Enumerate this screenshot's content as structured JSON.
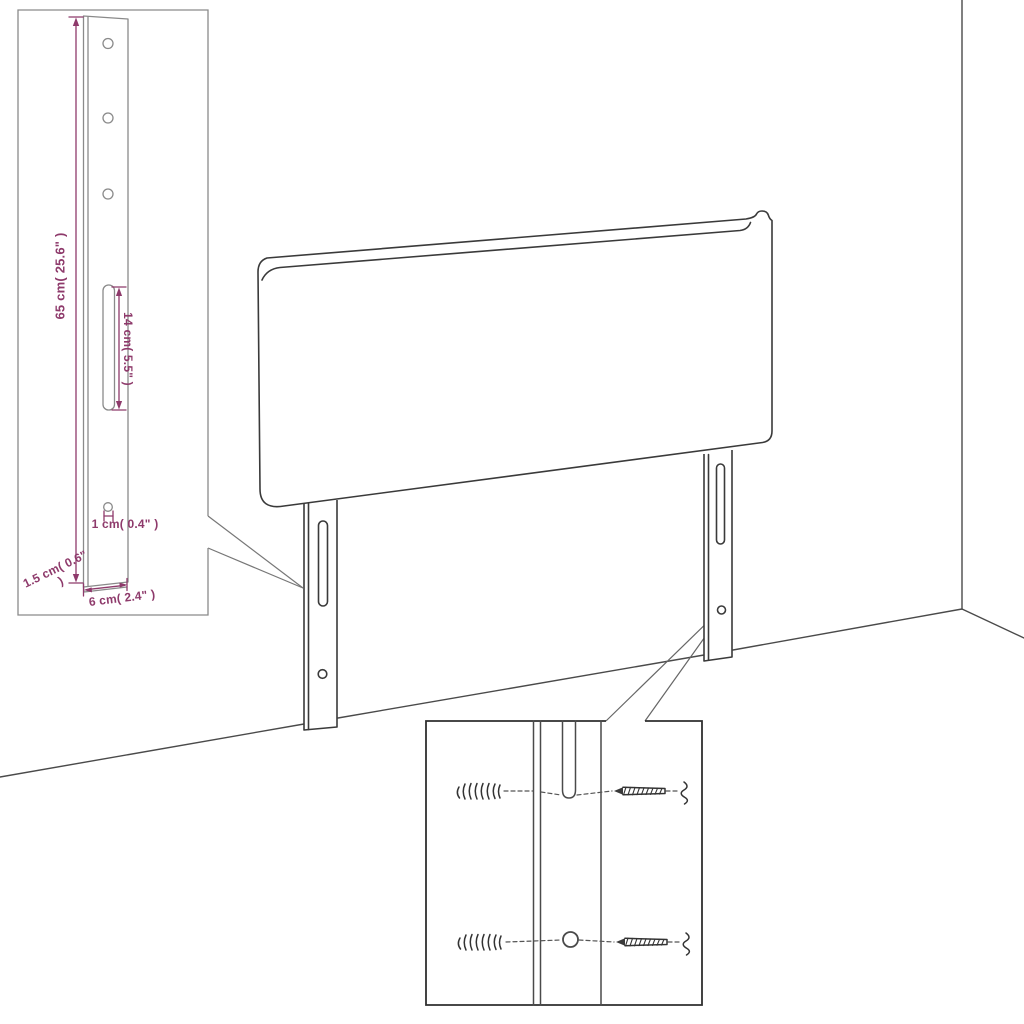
{
  "diagram": {
    "type": "product-dimension-diagram",
    "subject": "upholstered headboard with two mounting legs, wall corner background, two detail insets",
    "labels": {
      "leg_height": "65 cm( 25.6\" )",
      "slot_length": "14 cm( 5.5\" )",
      "hole_diameter": "1 cm( 0.4\" )",
      "leg_thickness": "1.5 cm( 0.6\" )",
      "leg_width": "6 cm( 2.4\" )"
    },
    "colors": {
      "dimension": "#8e3a6b",
      "line_main": "#3a3a3a",
      "line_detail": "#8a8a8a",
      "inset_border_light": "#8a8a8a",
      "inset_border_dark": "#2f2f2f",
      "hardware": "#333333",
      "callout": "#777777",
      "background": "#ffffff"
    }
  }
}
